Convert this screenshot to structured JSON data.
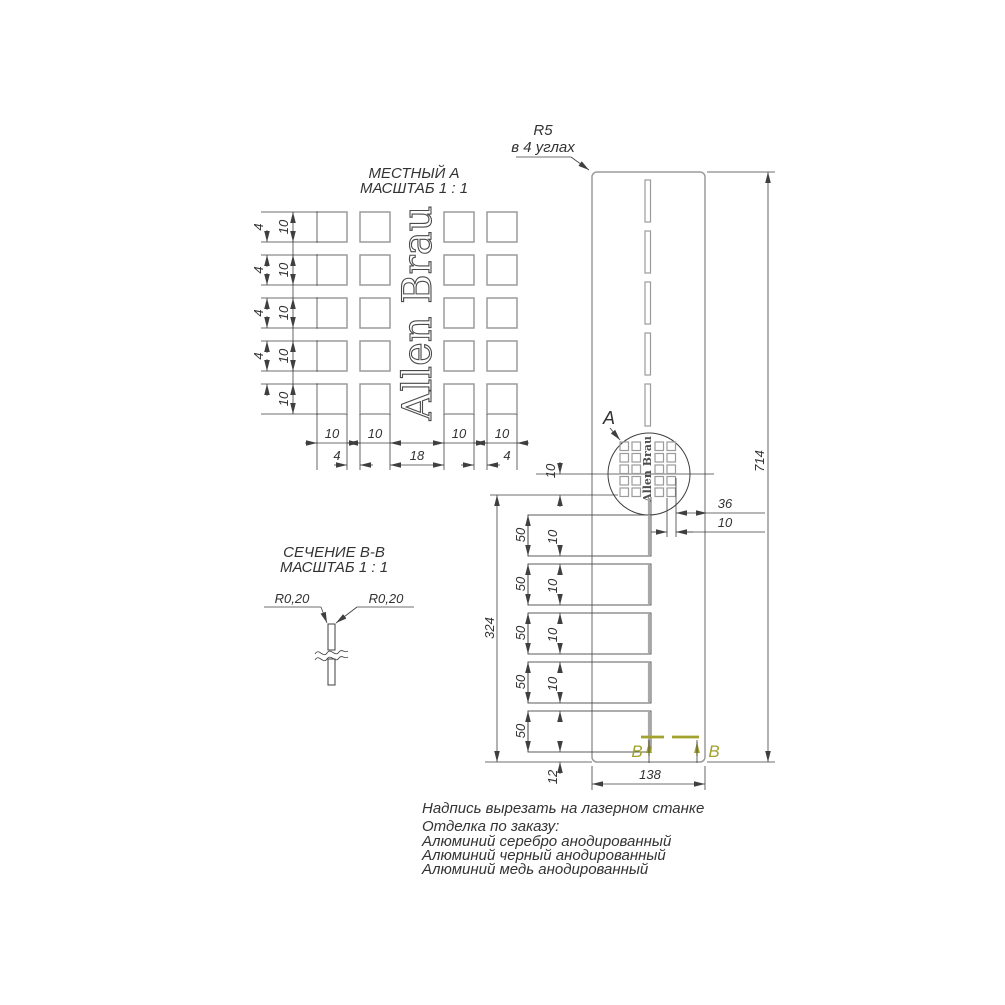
{
  "local_view": {
    "title": "МЕСТНЫЙ А",
    "scale": "МАСШТАБ 1 : 1",
    "logo": "Allen Brau",
    "dim_row": "10",
    "dim_row_gap": "4",
    "dim_col": "10",
    "dim_col_gap": "4",
    "dim_center_gap": "18"
  },
  "panel": {
    "radius_note_1": "R5",
    "radius_note_2": "в 4 углах",
    "detail_label": "A",
    "logo": "Allen Brau",
    "dim_height": "714",
    "dim_width": "138",
    "dim_lower": "324",
    "dim_slot": "50",
    "dim_gap": "10",
    "dim_bottom": "12",
    "dim_logo_margin": "36",
    "dim_logo_cell": "10",
    "dim_logo_row": "10",
    "section_letter": "B"
  },
  "section_view": {
    "title": "СЕЧЕНИЕ B-B",
    "scale": "МАСШТАБ 1 : 1",
    "radius_label": "R0,20"
  },
  "notes": {
    "line1": "Надпись вырезать на лазерном станке",
    "line2": "Отделка по заказу:",
    "line3": "Алюминий серебро анодированный",
    "line4": "Алюминий черный анодированный",
    "line5": "Алюминий медь анодированный"
  },
  "colors": {
    "line_dark": "#3f3f3f",
    "line_gray": "#9b9b9b",
    "section_mark": "#a2a22e"
  }
}
